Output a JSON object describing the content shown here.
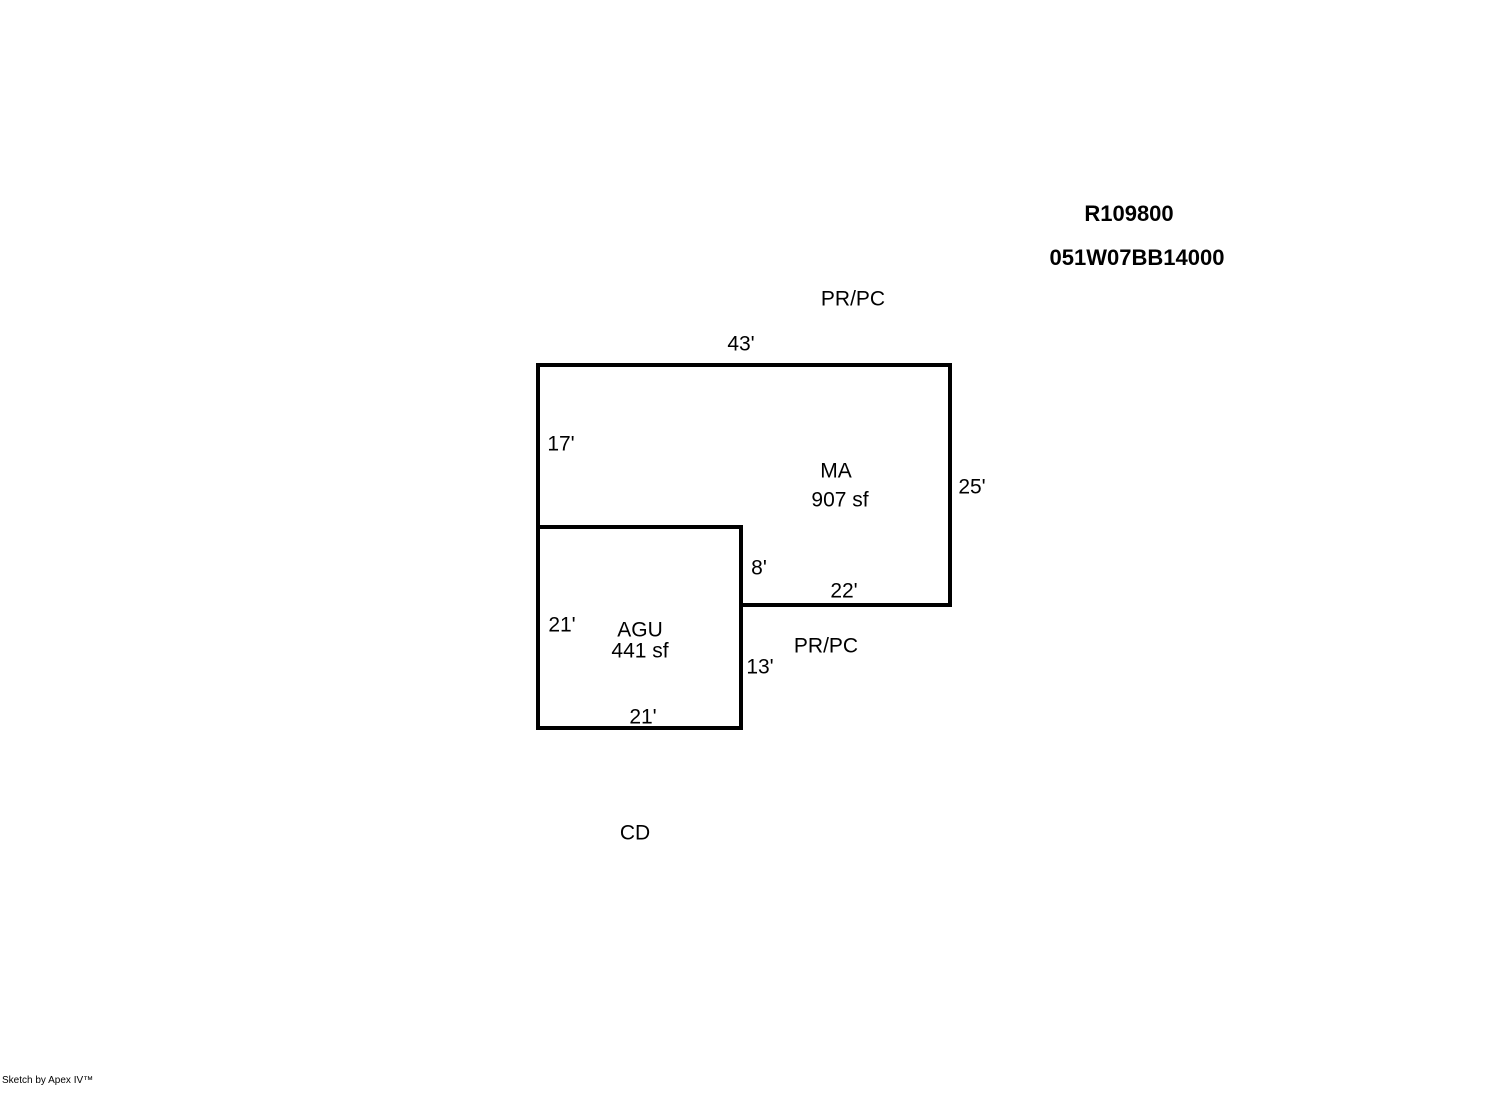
{
  "header": {
    "account_number": "R109800",
    "map_taxlot": "051W07BB14000"
  },
  "sketch": {
    "line_color": "#000000",
    "ma": {
      "code": "MA",
      "area": "907 sf",
      "dim_top": "43'",
      "dim_left": "17'",
      "dim_right": "25'",
      "dim_bottom": "22'",
      "dim_notch": "8'"
    },
    "agu": {
      "code": "AGU",
      "area": "441 sf",
      "dim_left": "21'",
      "dim_right": "13'",
      "dim_bottom": "21'"
    },
    "annotations": {
      "prpc_top": "PR/PC",
      "prpc_mid": "PR/PC",
      "cd": "CD"
    }
  },
  "footer": {
    "watermark": "Sketch by Apex IV™"
  }
}
